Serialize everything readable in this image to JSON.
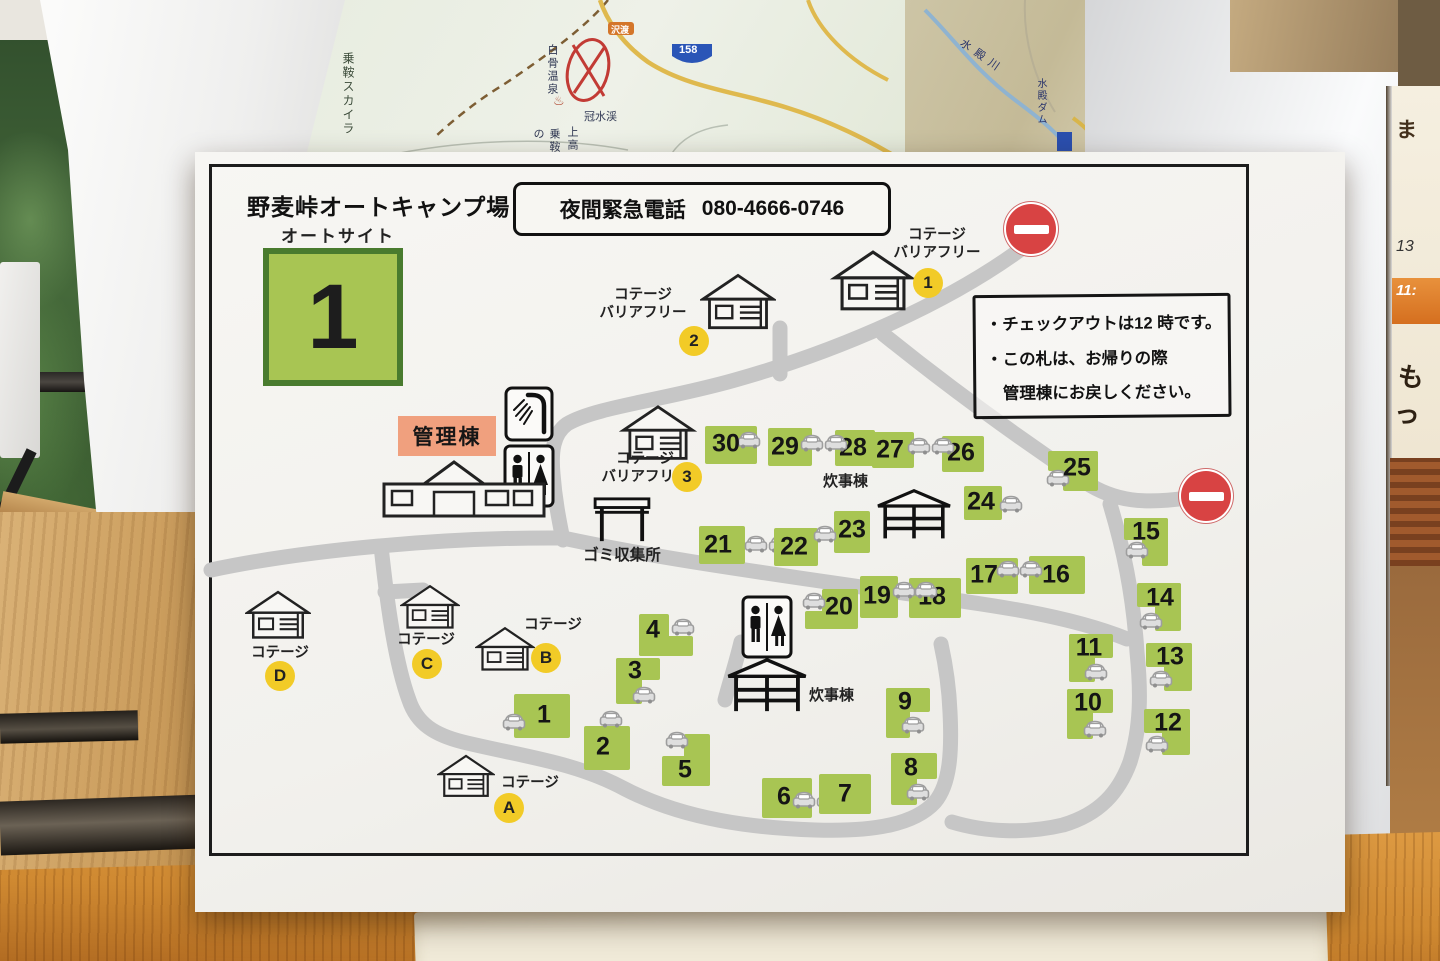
{
  "background": {
    "left_map": {
      "labels": {
        "norikura_skyline": "乗鞍スカイラ",
        "shirahone_onsen": "白骨温泉",
        "kanmurisui_kei": "冠水渓",
        "kamikochi": "上高",
        "norikura_no": "乗鞍の",
        "sawando": "沢渡",
        "route158": "158"
      }
    },
    "right_map": {
      "labels": {
        "midono_river": "水殿川",
        "midono_dam": "水殿ダム"
      }
    },
    "side_paper": {
      "items": [
        "ま",
        "13",
        "11:",
        "もっ"
      ]
    }
  },
  "colors": {
    "site_green": "#a8c553",
    "card_border_green": "#497b2e",
    "badge_yellow": "#f2cb27",
    "admin_salmon": "#f0a07e",
    "road_gray": "#c6c6c6",
    "no_entry_red": "#d84343"
  },
  "sheet": {
    "title": "野麦峠オートキャンプ場",
    "phone": {
      "label": "夜間緊急電話",
      "number": "080-4666-0746"
    },
    "autosite": {
      "label": "オートサイト",
      "number": "1"
    },
    "notice": {
      "lines": [
        "・チェックアウトは12 時です。",
        "・この札は、お帰りの際",
        "　管理棟にお戻しください。"
      ]
    },
    "labels": {
      "admin": "管理棟",
      "garbage": "ゴミ収集所",
      "kitchen": "炊事棟",
      "cottage": "コテージ",
      "barrier_free": "バリアフリー"
    },
    "no_entry_signs": [
      {
        "x": 811,
        "y": 52
      },
      {
        "x": 986,
        "y": 319
      }
    ],
    "kitchens": [
      {
        "icon": [
          679,
          336,
          80,
          54
        ],
        "label": [
          628,
          318
        ]
      },
      {
        "icon": [
          530,
          505,
          84,
          58
        ],
        "label": [
          614,
          532
        ]
      }
    ],
    "toilets": [
      [
        308,
        292,
        52,
        64
      ],
      [
        546,
        443,
        52,
        64
      ]
    ],
    "shower": [
      309,
      234,
      50,
      56
    ],
    "admin_building": [
      187,
      306,
      164,
      62
    ],
    "garbage_icon": [
      397,
      344,
      60,
      48
    ],
    "garbage_label_pos": [
      377,
      394
    ],
    "barrier_free_cottages": [
      {
        "id": "1",
        "house": [
          633,
          97,
          90,
          66
        ],
        "label": [
          690,
          74
        ],
        "circle": [
          718,
          116
        ]
      },
      {
        "id": "2",
        "house": [
          505,
          120,
          76,
          62
        ],
        "label": [
          396,
          134
        ],
        "circle": [
          484,
          174
        ]
      },
      {
        "id": "3",
        "house": [
          424,
          252,
          78,
          60
        ],
        "label": [
          398,
          298
        ],
        "circle": [
          477,
          310
        ]
      }
    ],
    "cottages": [
      {
        "id": "A",
        "house": [
          242,
          598,
          58,
          54
        ],
        "label": [
          300,
          622
        ],
        "circle": [
          299,
          641
        ]
      },
      {
        "id": "B",
        "house": [
          280,
          470,
          60,
          56
        ],
        "label": [
          323,
          464
        ],
        "circle": [
          336,
          491
        ]
      },
      {
        "id": "C",
        "house": [
          205,
          428,
          60,
          56
        ],
        "label": [
          196,
          479
        ],
        "circle": [
          217,
          497
        ]
      },
      {
        "id": "D",
        "house": [
          50,
          434,
          66,
          60
        ],
        "label": [
          50,
          492
        ],
        "circle": [
          70,
          509
        ]
      }
    ],
    "sites": [
      {
        "n": "1",
        "rects": [
          [
            319,
            542,
            56,
            44
          ]
        ],
        "label": [
          349,
          563
        ],
        "cars": [
          [
            307,
            560
          ]
        ]
      },
      {
        "n": "2",
        "rects": [
          [
            389,
            574,
            46,
            44
          ]
        ],
        "label": [
          408,
          595
        ],
        "cars": [
          [
            404,
            557
          ]
        ]
      },
      {
        "n": "3",
        "rects": [
          [
            421,
            506,
            44,
            22
          ],
          [
            421,
            506,
            26,
            46
          ]
        ],
        "label": [
          440,
          519
        ],
        "cars": [
          [
            437,
            533
          ]
        ]
      },
      {
        "n": "4",
        "rects": [
          [
            444,
            462,
            30,
            42
          ],
          [
            444,
            484,
            54,
            20
          ]
        ],
        "label": [
          458,
          478
        ],
        "cars": [
          [
            476,
            465
          ]
        ]
      },
      {
        "n": "5",
        "rects": [
          [
            467,
            604,
            48,
            30
          ],
          [
            489,
            582,
            26,
            52
          ]
        ],
        "label": [
          490,
          618
        ],
        "cars": [
          [
            470,
            578
          ]
        ]
      },
      {
        "n": "6",
        "rects": [
          [
            567,
            626,
            50,
            40
          ]
        ],
        "label": [
          589,
          645
        ],
        "cars": [
          [
            597,
            638
          ],
          [
            621,
            638
          ]
        ]
      },
      {
        "n": "7",
        "rects": [
          [
            624,
            622,
            52,
            40
          ]
        ],
        "label": [
          650,
          642
        ],
        "cars": []
      },
      {
        "n": "8",
        "rects": [
          [
            696,
            601,
            46,
            26
          ],
          [
            696,
            601,
            26,
            52
          ]
        ],
        "label": [
          716,
          616
        ],
        "cars": [
          [
            711,
            630
          ]
        ]
      },
      {
        "n": "9",
        "rects": [
          [
            691,
            536,
            44,
            24
          ],
          [
            691,
            536,
            24,
            50
          ]
        ],
        "label": [
          710,
          550
        ],
        "cars": [
          [
            706,
            563
          ]
        ]
      },
      {
        "n": "10",
        "rects": [
          [
            872,
            537,
            46,
            24
          ],
          [
            872,
            537,
            26,
            50
          ]
        ],
        "label": [
          893,
          551
        ],
        "cars": [
          [
            888,
            567
          ]
        ]
      },
      {
        "n": "11",
        "rects": [
          [
            874,
            482,
            44,
            24
          ],
          [
            874,
            482,
            26,
            48
          ]
        ],
        "label": [
          894,
          496
        ],
        "cars": [
          [
            889,
            510
          ]
        ]
      },
      {
        "n": "12",
        "rects": [
          [
            949,
            557,
            46,
            24
          ],
          [
            967,
            557,
            28,
            46
          ]
        ],
        "label": [
          973,
          571
        ],
        "cars": [
          [
            950,
            582
          ]
        ]
      },
      {
        "n": "13",
        "rects": [
          [
            951,
            491,
            46,
            24
          ],
          [
            969,
            491,
            28,
            48
          ]
        ],
        "label": [
          975,
          505
        ],
        "cars": [
          [
            954,
            517
          ]
        ]
      },
      {
        "n": "14",
        "rects": [
          [
            942,
            431,
            44,
            24
          ],
          [
            960,
            431,
            26,
            48
          ]
        ],
        "label": [
          965,
          446
        ],
        "cars": [
          [
            944,
            459
          ]
        ]
      },
      {
        "n": "15",
        "rects": [
          [
            929,
            366,
            44,
            22
          ],
          [
            947,
            366,
            26,
            48
          ]
        ],
        "label": [
          951,
          380
        ],
        "cars": [
          [
            930,
            388
          ]
        ]
      },
      {
        "n": "16",
        "rects": [
          [
            834,
            404,
            56,
            38
          ]
        ],
        "label": [
          861,
          423
        ],
        "cars": []
      },
      {
        "n": "17",
        "rects": [
          [
            771,
            406,
            52,
            36
          ]
        ],
        "label": [
          789,
          423
        ],
        "cars": [
          [
            801,
            407
          ],
          [
            824,
            407
          ]
        ]
      },
      {
        "n": "18",
        "rects": [
          [
            714,
            426,
            52,
            40
          ]
        ],
        "label": [
          737,
          445
        ],
        "cars": []
      },
      {
        "n": "19",
        "rects": [
          [
            665,
            424,
            38,
            42
          ]
        ],
        "label": [
          682,
          444
        ],
        "cars": [
          [
            697,
            428
          ],
          [
            719,
            428
          ]
        ]
      },
      {
        "n": "20",
        "rects": [
          [
            627,
            437,
            36,
            40
          ],
          [
            610,
            459,
            42,
            18
          ]
        ],
        "label": [
          644,
          455
        ],
        "cars": [
          [
            607,
            439
          ]
        ]
      },
      {
        "n": "21",
        "rects": [
          [
            504,
            374,
            46,
            38
          ]
        ],
        "label": [
          523,
          393
        ],
        "cars": [
          [
            549,
            382
          ],
          [
            573,
            382
          ]
        ]
      },
      {
        "n": "22",
        "rects": [
          [
            579,
            376,
            44,
            38
          ]
        ],
        "label": [
          599,
          395
        ],
        "cars": []
      },
      {
        "n": "23",
        "rects": [
          [
            639,
            359,
            36,
            42
          ]
        ],
        "label": [
          657,
          378
        ],
        "cars": [
          [
            618,
            372
          ]
        ]
      },
      {
        "n": "24",
        "rects": [
          [
            769,
            334,
            38,
            34
          ]
        ],
        "label": [
          786,
          350
        ],
        "cars": [
          [
            804,
            342
          ]
        ]
      },
      {
        "n": "25",
        "rects": [
          [
            853,
            299,
            50,
            20
          ],
          [
            868,
            299,
            35,
            40
          ]
        ],
        "label": [
          882,
          316
        ],
        "cars": [
          [
            851,
            316
          ]
        ]
      },
      {
        "n": "26",
        "rects": [
          [
            747,
            284,
            42,
            36
          ]
        ],
        "label": [
          766,
          301
        ],
        "cars": []
      },
      {
        "n": "27",
        "rects": [
          [
            677,
            280,
            42,
            36
          ]
        ],
        "label": [
          695,
          298
        ],
        "cars": [
          [
            712,
            284
          ],
          [
            736,
            284
          ]
        ]
      },
      {
        "n": "28",
        "rects": [
          [
            640,
            278,
            40,
            36
          ]
        ],
        "label": [
          658,
          296
        ],
        "cars": []
      },
      {
        "n": "29",
        "rects": [
          [
            573,
            276,
            44,
            38
          ]
        ],
        "label": [
          590,
          295
        ],
        "cars": [
          [
            605,
            281
          ],
          [
            629,
            281
          ]
        ]
      },
      {
        "n": "30",
        "rects": [
          [
            510,
            274,
            52,
            38
          ]
        ],
        "label": [
          531,
          292
        ],
        "cars": [
          [
            542,
            278
          ]
        ]
      }
    ]
  }
}
